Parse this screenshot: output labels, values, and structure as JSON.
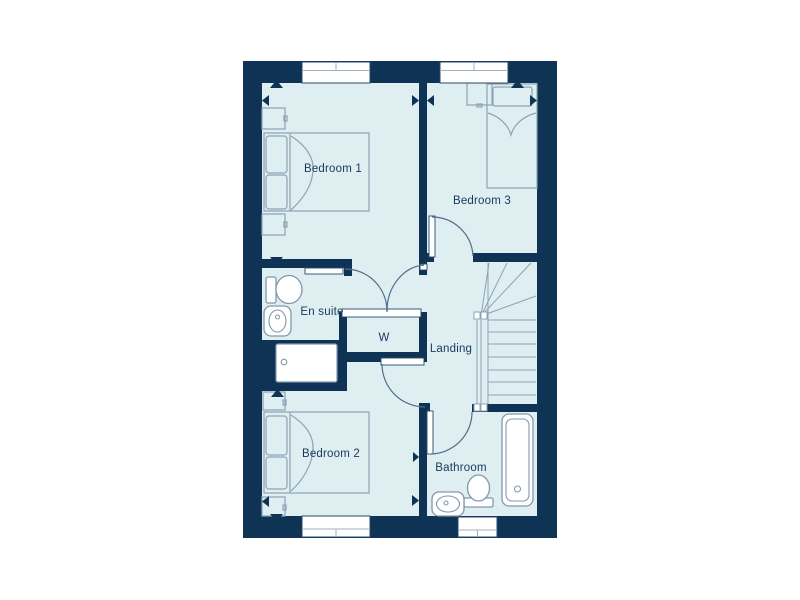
{
  "plan": {
    "rooms": [
      {
        "id": "bedroom-1",
        "label": "Bedroom 1"
      },
      {
        "id": "bedroom-3",
        "label": "Bedroom 3"
      },
      {
        "id": "en-suite",
        "label": "En suite"
      },
      {
        "id": "wardrobe",
        "label": "W"
      },
      {
        "id": "landing",
        "label": "Landing"
      },
      {
        "id": "bedroom-2",
        "label": "Bedroom 2"
      },
      {
        "id": "bathroom",
        "label": "Bathroom"
      }
    ],
    "fixtures": [
      "double-bed",
      "single-bed",
      "bedside-table",
      "wardrobe",
      "staircase",
      "bath",
      "shower-tray",
      "toilet",
      "wash-basin",
      "window",
      "door-swing",
      "dimension-arrow"
    ],
    "colors": {
      "wall": "#0e3355",
      "floor": "#dfeef0",
      "label_text": "#17395f",
      "furniture_line": "#8ca3b6",
      "door_arc": "#4f6f8f",
      "window_fill": "#ffffff",
      "background": "#ffffff"
    }
  }
}
